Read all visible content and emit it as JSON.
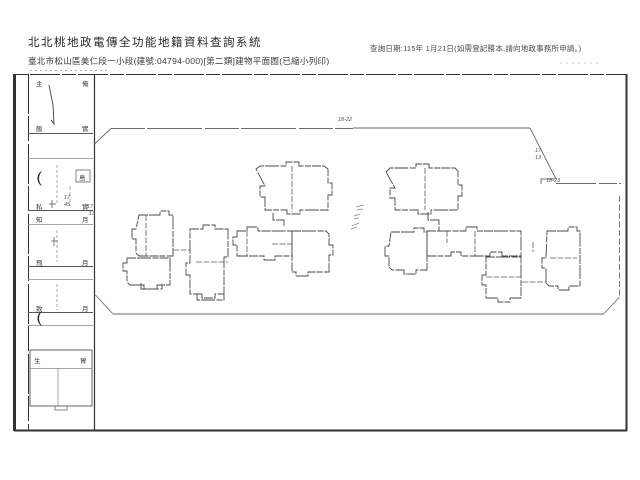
{
  "header": {
    "system_title": "北北桃地政電傳全功能地籍資料查詢系統",
    "document_subtitle": "臺北市松山區美仁段一小段(建號:04794-000)[第二類]建物平面圖(已縮小列印)",
    "query_date_note": "查詢日期:115年 1月21日(如需登記謄本,請向地政事務所申請。)"
  },
  "plan": {
    "parcel_labels": {
      "top": "18-22",
      "diag_upper": "17",
      "diag_lower": "13",
      "corner": "18-23",
      "left_upper": "17",
      "left_lower": "13"
    },
    "strip_marks": [
      "主",
      "俺",
      "飯",
      "實",
      "島",
      "17",
      "45",
      "私",
      "實",
      "知",
      "月",
      "飛",
      "月",
      "致",
      "月",
      "生",
      "胃"
    ]
  }
}
